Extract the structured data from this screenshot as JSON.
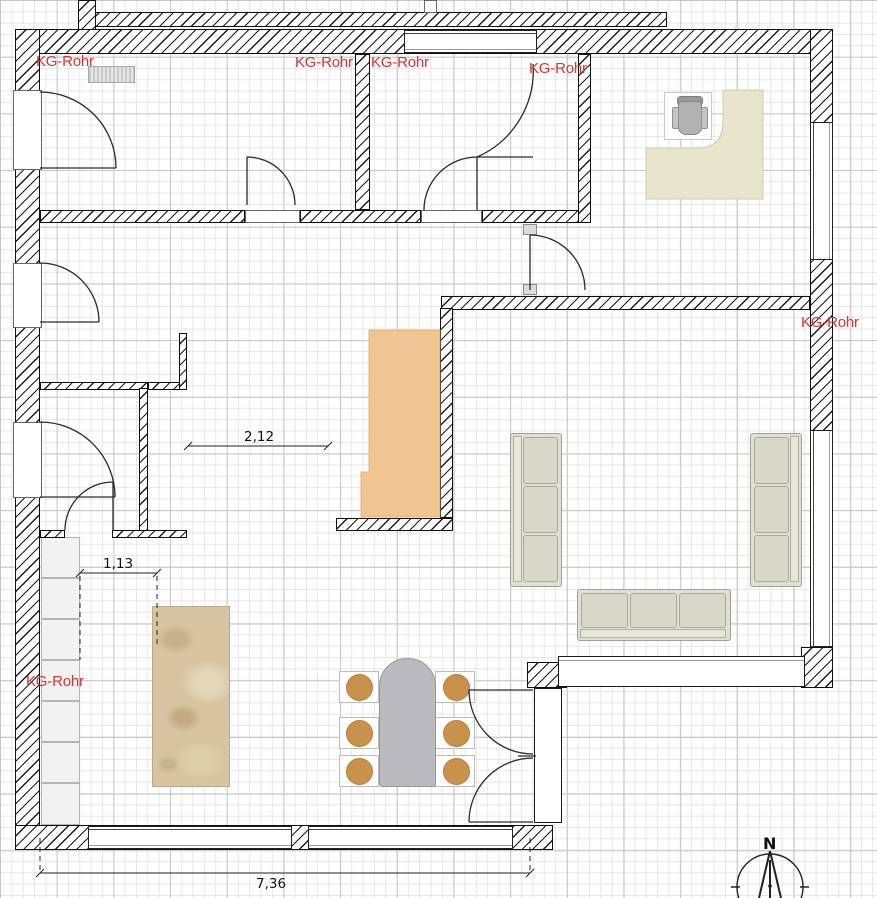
{
  "annotations": {
    "kg_rohr_labels": [
      {
        "text": "KG-Rohr"
      },
      {
        "text": "KG-Rohr"
      },
      {
        "text": "KG-Rohr"
      },
      {
        "text": "KG-Rohr"
      },
      {
        "text": "KG-Rohr"
      },
      {
        "text": "KG-Rohr"
      }
    ],
    "dimensions": [
      {
        "name": "hall-width",
        "value": "2,12"
      },
      {
        "name": "island-offset",
        "value": "1,13"
      },
      {
        "name": "building-width",
        "value": "7,36"
      }
    ],
    "compass": {
      "north": "N"
    }
  },
  "furniture": [
    {
      "name": "radiator"
    },
    {
      "name": "corner-desk"
    },
    {
      "name": "office-chair"
    },
    {
      "name": "wardrobe"
    },
    {
      "name": "sofa-left"
    },
    {
      "name": "sofa-right"
    },
    {
      "name": "sofa-bottom"
    },
    {
      "name": "dining-table"
    },
    {
      "name": "dining-chairs",
      "count": 6
    },
    {
      "name": "kitchen-island"
    },
    {
      "name": "kitchen-counter-units",
      "count": 7
    }
  ],
  "colors": {
    "label_red": "#d8332e",
    "wall_line": "#1b1b1b",
    "desk": "#e9e5cd",
    "sofa": "#dfdfd2",
    "wardrobe": "#f0c592",
    "island": "#d7c5a2",
    "table": "#bbbbbf",
    "chair_seat": "#c9924c"
  }
}
